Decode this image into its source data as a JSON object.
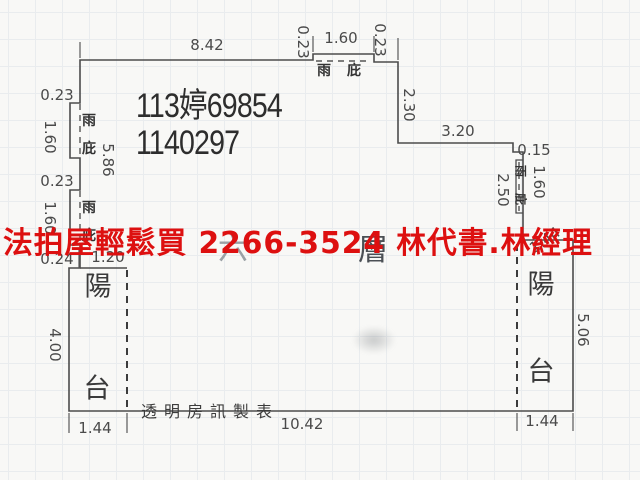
{
  "colors": {
    "overlay_red": "#dd1010",
    "wall_line": "#4c4c4c",
    "case_text": "#2d2d2d",
    "background": "#f8f8f6"
  },
  "overlay": {
    "ad_text": "法拍屋輕鬆買  2266-3524  林代書.林經理"
  },
  "case_numbers": {
    "line1": "113婷69854",
    "line2": "1140297"
  },
  "floor_label": {
    "char1": "六",
    "char2": "層"
  },
  "publisher": {
    "text": "透明房訊製表"
  },
  "rooms": {
    "balcony_left": {
      "char1": "陽",
      "char2": "台"
    },
    "balcony_right": {
      "char1": "陽",
      "char2": "台"
    },
    "canopy_top": {
      "char1": "雨",
      "char2": "庇"
    },
    "canopy_left_upper": {
      "char1": "雨",
      "char2": "庇"
    },
    "canopy_left_lower": {
      "char1": "雨",
      "char2": "庇"
    },
    "canopy_right": {
      "char1": "雨",
      "char2": "庇"
    }
  },
  "dimensions": {
    "top_width": "8.42",
    "canopy_top_left_offset": "0.23",
    "canopy_top_width": "1.60",
    "canopy_top_right_offset": "0.23",
    "right_upper_depth": "2.30",
    "right_step_width": "3.20",
    "right_step_offset": "0.15",
    "canopy_right_span": "2.50",
    "canopy_right_length": "1.60",
    "balcony_right_top_width": "1.44",
    "balcony_right_height": "5.06",
    "left_canopy_upper_offset": "0.23",
    "left_canopy_upper_length": "1.60",
    "left_wall_inner": "5.86",
    "left_canopy_lower_offset": "0.23",
    "left_canopy_lower_length": "1.60",
    "balcony_left_step": "0.24",
    "balcony_left_inner_width": "1.20",
    "balcony_left_height": "4.00",
    "balcony_left_bottom_width": "1.44",
    "bottom_width": "10.42",
    "balcony_right_bottom_width": "1.44"
  }
}
